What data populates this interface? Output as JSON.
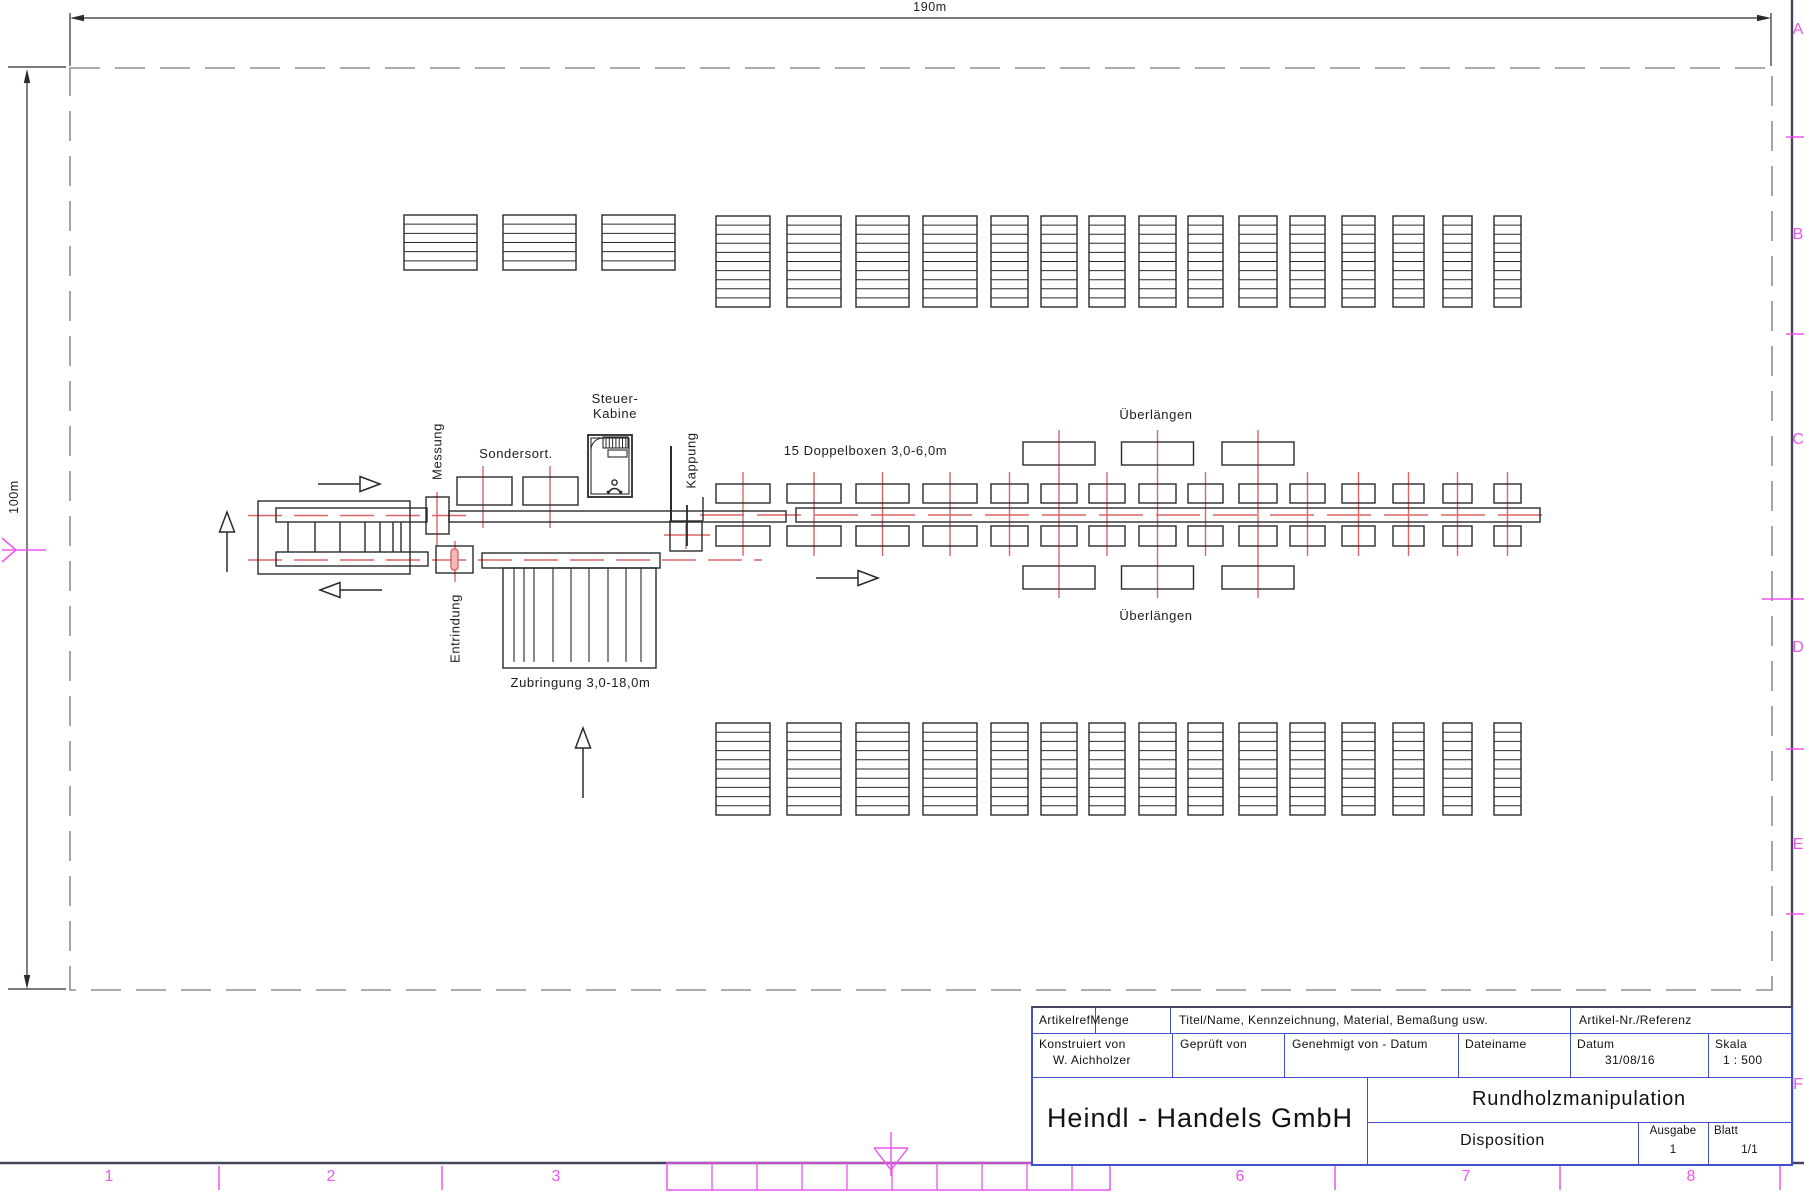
{
  "drawing": {
    "dimensions": {
      "top": "190m",
      "left": "100m"
    },
    "labels": {
      "messung": "Messung",
      "sondersort": "Sondersort.",
      "steuer_line1": "Steuer-",
      "steuer_line2": "Kabine",
      "kappung": "Kappung",
      "doppelboxen": "15 Doppelboxen 3,0-6,0m",
      "ueberlaengen_top": "Überlängen",
      "ueberlaengen_bottom": "Überlängen",
      "entrindung": "Entrindung",
      "zubringung": "Zubringung 3,0-18,0m"
    }
  },
  "grid": {
    "rows": [
      "A",
      "B",
      "C",
      "D",
      "E",
      "F"
    ],
    "cols": [
      "1",
      "2",
      "3",
      "6",
      "7",
      "8"
    ]
  },
  "title_block": {
    "artikelref": "Artikelref",
    "menge": "Menge",
    "titel": "Titel/Name, Kennzeichnung, Material, Bemaßung usw.",
    "artikel_nr": "Artikel-Nr./Referenz",
    "konstruiert_label": "Konstruiert von",
    "konstruiert_value": "W. Aichholzer",
    "geprueft_label": "Geprüft von",
    "genehmigt_label": "Genehmigt von - Datum",
    "dateiname_label": "Dateiname",
    "datum_label": "Datum",
    "datum_value": "31/08/16",
    "skala_label": "Skala",
    "skala_value": "1 : 500",
    "company": "Heindl - Handels GmbH",
    "project": "Rundholzmanipulation",
    "doc_type": "Disposition",
    "ausgabe_label": "Ausgabe",
    "ausgabe_value": "1",
    "blatt_label": "Blatt",
    "blatt_value": "1/1"
  },
  "colors": {
    "line": "#2a2a2a",
    "centerline_red": "#dd6565",
    "grid_magenta": "#ee55ee",
    "titleblock_blue": "#4050cc",
    "sheet_frame": "#44445a",
    "boundary_gray": "#8f8f8f"
  }
}
